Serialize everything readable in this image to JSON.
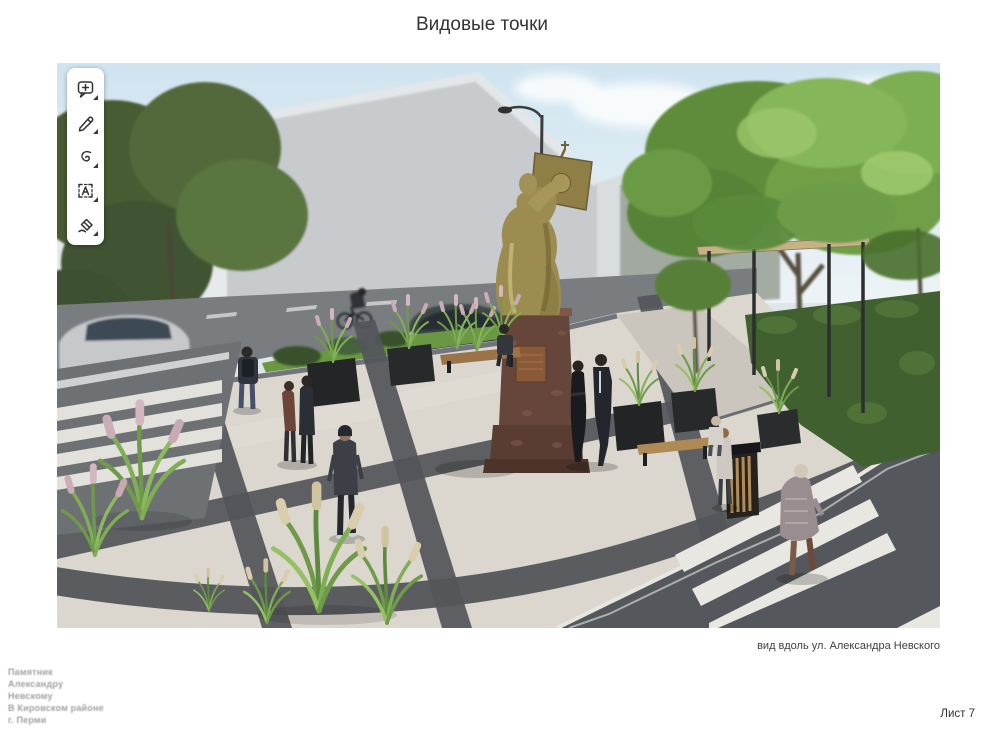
{
  "page": {
    "title": "Видовые точки",
    "sheet_label": "Лист 7",
    "background_color": "#ffffff"
  },
  "annotation_toolbar": {
    "tools": [
      {
        "icon": "add-comment-icon"
      },
      {
        "icon": "pen-icon"
      },
      {
        "icon": "highlighter-icon"
      },
      {
        "icon": "text-select-icon"
      },
      {
        "icon": "eraser-icon"
      }
    ]
  },
  "rendering": {
    "caption": "вид вдоль ул. Александра Невского",
    "palette": {
      "sky": "#cfe4f0",
      "foliage": "#5f8c3b",
      "paving_light": "#dbd7cf",
      "paving_dark": "#53555a",
      "asphalt": "#7a7d80",
      "statue_gold": "#9c8c50",
      "pedestal_granite": "#66463a"
    }
  },
  "title_block": {
    "lines": [
      "Памятник",
      "Александру",
      "Невскому",
      "В Кировском районе",
      "г. Перми"
    ]
  }
}
